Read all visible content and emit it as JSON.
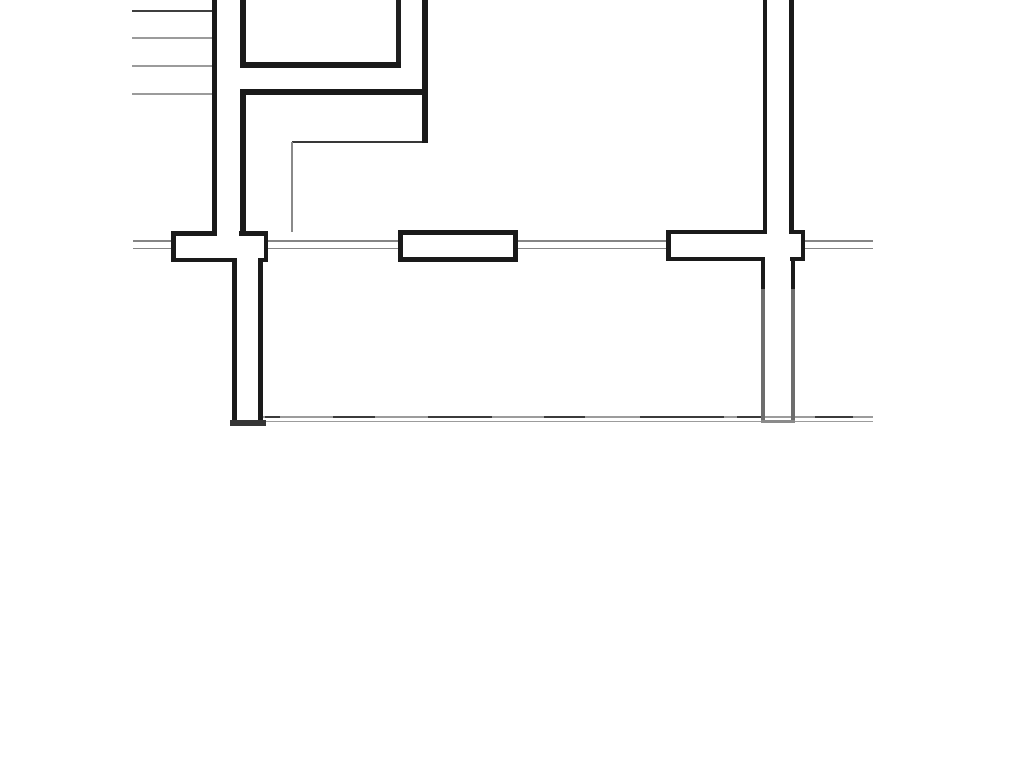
{
  "document": {
    "type": "floor-plan-drawing",
    "description_visible_text": "",
    "background": "#ffffff",
    "width": 1024,
    "height": 768
  },
  "palette": {
    "wall_black": "#1a1a1a",
    "wall_dark_gray": "#353535",
    "thin_dark_line": "#3b3b3b",
    "thin_gray_line": "#9b9b9b",
    "sill_gray": "#858585",
    "faded_wall_gray": "#6d6d6d",
    "cap_gray": "#8a8a8a"
  },
  "elements": [
    {
      "name": "stair-tread-line-1",
      "x": 132,
      "y": 10,
      "w": 81,
      "h": 2,
      "color": "#3f3f3f"
    },
    {
      "name": "stair-tread-line-2",
      "x": 132,
      "y": 37,
      "w": 81,
      "h": 1.8,
      "color": "#9b9b9b"
    },
    {
      "name": "stair-tread-line-3",
      "x": 132,
      "y": 65,
      "w": 81,
      "h": 1.8,
      "color": "#9b9b9b"
    },
    {
      "name": "stair-tread-line-4",
      "x": 132,
      "y": 93,
      "w": 81,
      "h": 1.8,
      "color": "#9b9b9b"
    },
    {
      "name": "window-sill-upper-seg-1",
      "x": 133,
      "y": 239.8,
      "w": 38,
      "h": 1.8,
      "color": "#858585"
    },
    {
      "name": "window-sill-lower-seg-1",
      "x": 133,
      "y": 247.6,
      "w": 38,
      "h": 1.8,
      "color": "#858585"
    },
    {
      "name": "window-sill-upper-seg-2",
      "x": 268,
      "y": 239.8,
      "w": 130,
      "h": 1.8,
      "color": "#858585"
    },
    {
      "name": "window-sill-lower-seg-2",
      "x": 268,
      "y": 247.6,
      "w": 130,
      "h": 1.8,
      "color": "#858585"
    },
    {
      "name": "window-sill-upper-seg-3",
      "x": 518,
      "y": 239.8,
      "w": 148,
      "h": 1.8,
      "color": "#858585"
    },
    {
      "name": "window-sill-lower-seg-3",
      "x": 518,
      "y": 247.6,
      "w": 148,
      "h": 1.8,
      "color": "#858585"
    },
    {
      "name": "window-sill-upper-seg-4",
      "x": 805,
      "y": 239.8,
      "w": 68,
      "h": 1.8,
      "color": "#858585"
    },
    {
      "name": "window-sill-lower-seg-4",
      "x": 805,
      "y": 247.6,
      "w": 68,
      "h": 1.8,
      "color": "#858585"
    },
    {
      "name": "boundary-line-upper",
      "x": 263,
      "y": 416.2,
      "w": 610,
      "h": 1.7,
      "color": "#9c9c9c"
    },
    {
      "name": "boundary-line-lower",
      "x": 263,
      "y": 420.6,
      "w": 610,
      "h": 1.7,
      "color": "#9c9c9c"
    },
    {
      "name": "boundary-dash-1",
      "x": 265,
      "y": 415.7,
      "w": 15,
      "h": 2.6,
      "color": "#3b3b3b"
    },
    {
      "name": "boundary-dash-2",
      "x": 333,
      "y": 415.7,
      "w": 42,
      "h": 2.6,
      "color": "#3b3b3b"
    },
    {
      "name": "boundary-dash-3",
      "x": 428,
      "y": 415.7,
      "w": 64,
      "h": 2.6,
      "color": "#3b3b3b"
    },
    {
      "name": "boundary-dash-4",
      "x": 544,
      "y": 415.7,
      "w": 41,
      "h": 2.6,
      "color": "#3b3b3b"
    },
    {
      "name": "boundary-dash-5",
      "x": 640,
      "y": 415.7,
      "w": 84,
      "h": 2.6,
      "color": "#3b3b3b"
    },
    {
      "name": "boundary-dash-6",
      "x": 737,
      "y": 415.7,
      "w": 24,
      "h": 2.6,
      "color": "#3b3b3b"
    },
    {
      "name": "boundary-dash-7",
      "x": 815,
      "y": 415.7,
      "w": 38,
      "h": 2.6,
      "color": "#3b3b3b"
    },
    {
      "name": "window-frame-left-fill",
      "x": 171,
      "y": 231,
      "w": 97,
      "h": 31,
      "color": "#ffffff"
    },
    {
      "name": "window-frame-left-top-seg-1",
      "x": 171,
      "y": 231,
      "w": 46,
      "h": 4.5,
      "color": "#1a1a1a"
    },
    {
      "name": "window-frame-left-top-seg-2",
      "x": 239,
      "y": 231,
      "w": 29,
      "h": 4.5,
      "color": "#1a1a1a"
    },
    {
      "name": "window-frame-left-bottom-seg-1",
      "x": 171,
      "y": 257.5,
      "w": 66,
      "h": 4.5,
      "color": "#1a1a1a"
    },
    {
      "name": "window-frame-left-bottom-seg-2",
      "x": 258,
      "y": 257.5,
      "w": 10,
      "h": 4.5,
      "color": "#1a1a1a"
    },
    {
      "name": "window-frame-left-edge-left",
      "x": 171,
      "y": 231,
      "w": 4.5,
      "h": 31,
      "color": "#1a1a1a"
    },
    {
      "name": "window-frame-left-edge-right",
      "x": 263.5,
      "y": 231,
      "w": 4.5,
      "h": 31,
      "color": "#1a1a1a"
    },
    {
      "name": "window-frame-middle-fill",
      "x": 398,
      "y": 229.5,
      "w": 120,
      "h": 32.5,
      "color": "#ffffff"
    },
    {
      "name": "window-frame-middle-top",
      "x": 398,
      "y": 229.5,
      "w": 120,
      "h": 5,
      "color": "#1a1a1a"
    },
    {
      "name": "window-frame-middle-bottom",
      "x": 398,
      "y": 257,
      "w": 120,
      "h": 5,
      "color": "#1a1a1a"
    },
    {
      "name": "window-frame-middle-edge-left",
      "x": 398,
      "y": 229.5,
      "w": 5,
      "h": 32.5,
      "color": "#1a1a1a"
    },
    {
      "name": "window-frame-middle-edge-right",
      "x": 513,
      "y": 229.5,
      "w": 5,
      "h": 32.5,
      "color": "#1a1a1a"
    },
    {
      "name": "window-frame-right-fill",
      "x": 666,
      "y": 229.5,
      "w": 139,
      "h": 31.5,
      "color": "#ffffff"
    },
    {
      "name": "window-frame-right-top-seg-1",
      "x": 666,
      "y": 229.5,
      "w": 101,
      "h": 4.5,
      "color": "#1a1a1a"
    },
    {
      "name": "window-frame-right-top-seg-2",
      "x": 789,
      "y": 229.5,
      "w": 16,
      "h": 4.5,
      "color": "#1a1a1a"
    },
    {
      "name": "window-frame-right-bottom-seg-1",
      "x": 666,
      "y": 256.5,
      "w": 99,
      "h": 4.5,
      "color": "#1a1a1a"
    },
    {
      "name": "window-frame-right-bottom-seg-2",
      "x": 790,
      "y": 256.5,
      "w": 15,
      "h": 4.5,
      "color": "#1a1a1a"
    },
    {
      "name": "window-frame-right-edge-left",
      "x": 666,
      "y": 229.5,
      "w": 4.5,
      "h": 31.5,
      "color": "#1a1a1a"
    },
    {
      "name": "window-frame-right-edge-right",
      "x": 800.5,
      "y": 229.5,
      "w": 4.5,
      "h": 31.5,
      "color": "#1a1a1a"
    },
    {
      "name": "wall-stair-outer",
      "x": 212,
      "y": 0,
      "w": 5,
      "h": 235,
      "color": "#1a1a1a"
    },
    {
      "name": "wall-stair-inner-upper",
      "x": 240,
      "y": 0,
      "w": 6,
      "h": 68,
      "color": "#1a1a1a"
    },
    {
      "name": "wall-stair-inner-lower",
      "x": 240,
      "y": 89,
      "w": 6,
      "h": 146,
      "color": "#1a1a1a"
    },
    {
      "name": "room-bottom-wall",
      "x": 240,
      "y": 62,
      "w": 161,
      "h": 6,
      "color": "#1a1a1a"
    },
    {
      "name": "room-right-wall",
      "x": 396,
      "y": 0,
      "w": 5,
      "h": 62,
      "color": "#1f1f1f"
    },
    {
      "name": "partition-wall-horizontal",
      "x": 240,
      "y": 89,
      "w": 188,
      "h": 6,
      "color": "#1a1a1a"
    },
    {
      "name": "partition-wall-vertical",
      "x": 422,
      "y": 0,
      "w": 6,
      "h": 143,
      "color": "#1a1a1a"
    },
    {
      "name": "wall-top-right-outer",
      "x": 763,
      "y": 0,
      "w": 4,
      "h": 233,
      "color": "#1a1a1a"
    },
    {
      "name": "wall-top-right-inner",
      "x": 789,
      "y": 0,
      "w": 4.5,
      "h": 233,
      "color": "#1a1a1a"
    },
    {
      "name": "thin-wall-horizontal",
      "x": 292,
      "y": 140.5,
      "w": 130,
      "h": 2,
      "color": "#383838"
    },
    {
      "name": "thin-wall-vertical",
      "x": 291,
      "y": 142,
      "w": 2,
      "h": 90,
      "color": "#8a8a8a"
    },
    {
      "name": "wall-lower-left-outer",
      "x": 232,
      "y": 258,
      "w": 5,
      "h": 165,
      "color": "#1a1a1a"
    },
    {
      "name": "wall-lower-left-inner",
      "x": 258,
      "y": 258,
      "w": 5,
      "h": 165,
      "color": "#1a1a1a"
    },
    {
      "name": "wall-lower-left-cap",
      "x": 230,
      "y": 420,
      "w": 36,
      "h": 5.5,
      "color": "#353535"
    },
    {
      "name": "wall-lower-right-outer-dark",
      "x": 761,
      "y": 257,
      "w": 4,
      "h": 32,
      "color": "#1a1a1a"
    },
    {
      "name": "wall-lower-right-outer-faded",
      "x": 761,
      "y": 289,
      "w": 4,
      "h": 132,
      "color": "#6d6d6d"
    },
    {
      "name": "wall-lower-right-inner-dark",
      "x": 790.5,
      "y": 257,
      "w": 4,
      "h": 32,
      "color": "#1a1a1a"
    },
    {
      "name": "wall-lower-right-inner-faded",
      "x": 790.5,
      "y": 289,
      "w": 4,
      "h": 132,
      "color": "#6d6d6d"
    },
    {
      "name": "wall-lower-right-cap",
      "x": 761,
      "y": 419.5,
      "w": 33.5,
      "h": 3,
      "color": "#8a8a8a"
    }
  ]
}
